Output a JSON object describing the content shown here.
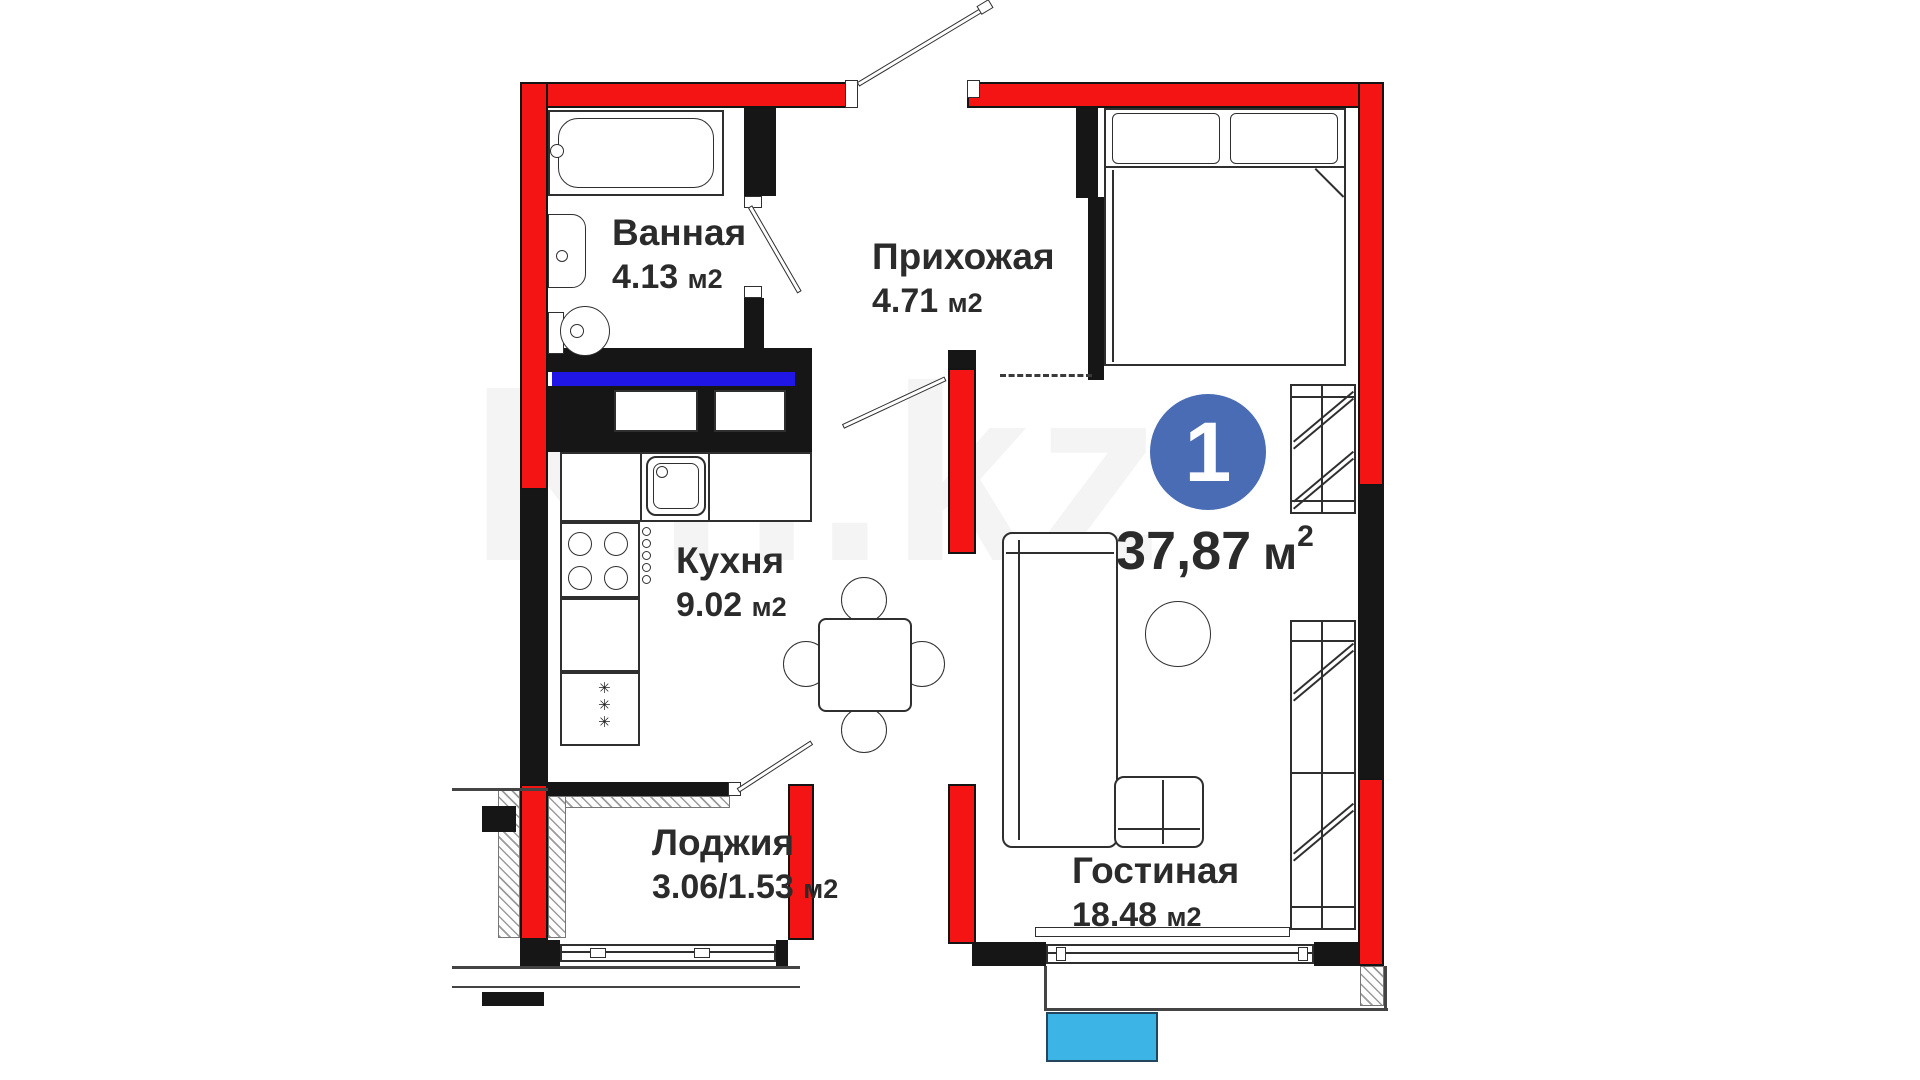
{
  "plan": {
    "unit_badge": {
      "number": "1",
      "area": "37,87",
      "unit": "м",
      "sup": "2"
    },
    "rooms": {
      "bathroom": {
        "name": "Ванная",
        "area": "4.13",
        "unit": "м2"
      },
      "hallway": {
        "name": "Прихожая",
        "area": "4.71",
        "unit": "м2"
      },
      "kitchen": {
        "name": "Кухня",
        "area": "9.02",
        "unit": "м2"
      },
      "loggia": {
        "name": "Лоджия",
        "area": "3.06/1.53",
        "unit": "м2"
      },
      "living": {
        "name": "Гостиная",
        "area": "18.48",
        "unit": "м2"
      }
    },
    "fridge_symbol": "✳\n✳\n✳",
    "watermark": "Kn.kz"
  },
  "colors": {
    "wall-red": "#f51414",
    "wall-black": "#161616",
    "blue-bar": "#2017e6",
    "badge-blue": "#4a6cb5",
    "cyan": "#3cb4e5",
    "ink": "#2f2f2f",
    "text": "#2b2b2b"
  }
}
